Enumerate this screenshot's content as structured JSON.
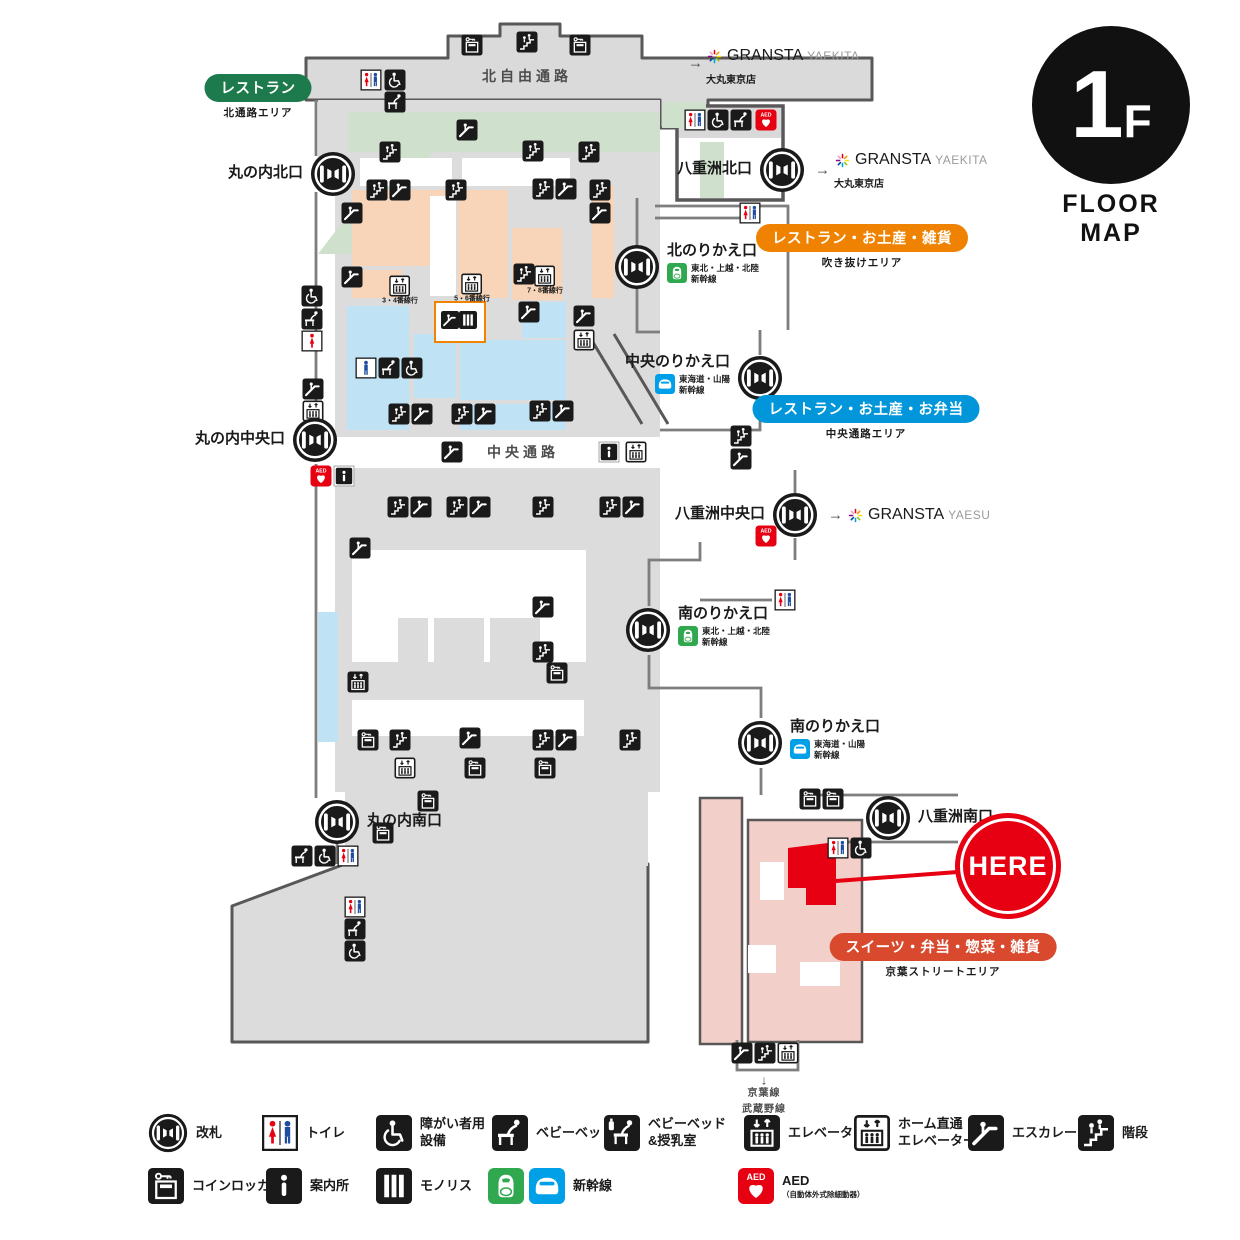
{
  "floor_badge": {
    "level_number": "1",
    "level_suffix": "F",
    "caption": "FLOOR MAP"
  },
  "colors": {
    "outline": "#595757",
    "floor_gray": "#dcdcdd",
    "green_area": "#cfe0cc",
    "peach_area": "#f8d5b8",
    "blue_area": "#bfe2f4",
    "pink_area": "#f3cfc9",
    "accent_red": "#e60012",
    "pill_green": "#1d7a4c",
    "pill_orange": "#ef8200",
    "pill_blue": "#0096d9",
    "pill_red": "#d8492e",
    "shinkansen_green": "#2fa84f",
    "shinkansen_blue": "#00a0e9"
  },
  "path_labels": [
    {
      "text": "北自由通路",
      "x": 527,
      "y": 76,
      "cls": ""
    },
    {
      "text": "中央通路",
      "x": 523,
      "y": 452,
      "cls": ""
    },
    {
      "text": "↓",
      "x": 764,
      "y": 1080,
      "cls": "tiny-arrow"
    },
    {
      "text": "京葉線\n武蔵野線",
      "x": 764,
      "y": 1102,
      "cls": "small"
    }
  ],
  "gates": [
    {
      "id": "marunouchi-north",
      "label": "丸の内北口",
      "x": 333,
      "y": 174,
      "side": "left"
    },
    {
      "id": "yaesu-north",
      "label": "八重洲北口",
      "x": 782,
      "y": 170,
      "side": "left",
      "arrow": "→",
      "logo": {
        "brand": "GRANSTA",
        "sub": "YAEKITA",
        "note": "大丸東京店"
      }
    },
    {
      "id": "north-transfer",
      "label": "北のりかえ口",
      "x": 637,
      "y": 267,
      "side": "right",
      "line": {
        "icon": "shinkansen-green",
        "text": "東北・上越・北陸\n新幹線"
      }
    },
    {
      "id": "central-transfer",
      "label": "中央のりかえ口",
      "x": 760,
      "y": 378,
      "side": "left",
      "line": {
        "icon": "shinkansen-blue",
        "text": "東海道・山陽\n新幹線"
      }
    },
    {
      "id": "marunouchi-central",
      "label": "丸の内中央口",
      "x": 315,
      "y": 440,
      "side": "left"
    },
    {
      "id": "yaesu-central",
      "label": "八重洲中央口",
      "x": 795,
      "y": 515,
      "side": "left",
      "arrow": "→",
      "logo": {
        "brand": "GRANSTA",
        "sub": "YAESU"
      }
    },
    {
      "id": "south-transfer-1",
      "label": "南のりかえ口",
      "x": 648,
      "y": 630,
      "side": "right",
      "line": {
        "icon": "shinkansen-green",
        "text": "東北・上越・北陸\n新幹線"
      }
    },
    {
      "id": "south-transfer-2",
      "label": "南のりかえ口",
      "x": 760,
      "y": 743,
      "side": "right",
      "line": {
        "icon": "shinkansen-blue",
        "text": "東海道・山陽\n新幹線"
      }
    },
    {
      "id": "marunouchi-south",
      "label": "丸の内南口",
      "x": 337,
      "y": 822,
      "side": "right"
    },
    {
      "id": "yaesu-south",
      "label": "八重洲南口",
      "x": 888,
      "y": 818,
      "side": "right"
    }
  ],
  "area_pills": [
    {
      "label": "レストラン",
      "sub": "北通路エリア",
      "color": "#1d7a4c",
      "x": 258,
      "y": 74
    },
    {
      "label": "レストラン・お土産・雑貨",
      "sub": "吹き抜けエリア",
      "color": "#ef8200",
      "x": 862,
      "y": 224
    },
    {
      "label": "レストラン・お土産・お弁当",
      "sub": "中央通路エリア",
      "color": "#0096d9",
      "x": 866,
      "y": 395
    },
    {
      "label": "スイーツ・弁当・惣菜・雑貨",
      "sub": "京葉ストリートエリア",
      "color": "#d8492e",
      "x": 943,
      "y": 933
    }
  ],
  "brand_links": [
    {
      "x": 688,
      "y": 63,
      "arrow": "→",
      "brand": "GRANSTA",
      "sub": "YAEKITA",
      "note": "大丸東京店"
    }
  ],
  "here_marker": {
    "label": "HERE",
    "x": 1008,
    "y": 866
  },
  "highlight_box": {
    "x": 434,
    "y": 301,
    "w": 48,
    "h": 38
  },
  "map_icons": [
    {
      "t": "locker",
      "x": 472,
      "y": 45
    },
    {
      "t": "stairs",
      "x": 527,
      "y": 42
    },
    {
      "t": "locker",
      "x": 580,
      "y": 45
    },
    {
      "t": "toilet",
      "x": 371,
      "y": 80
    },
    {
      "t": "wheelchair",
      "x": 395,
      "y": 80
    },
    {
      "t": "babybed",
      "x": 395,
      "y": 102
    },
    {
      "t": "escalator",
      "x": 467,
      "y": 130
    },
    {
      "t": "stairs",
      "x": 390,
      "y": 152
    },
    {
      "t": "stairs",
      "x": 533,
      "y": 151
    },
    {
      "t": "stairs",
      "x": 589,
      "y": 152
    },
    {
      "t": "toilet",
      "x": 695,
      "y": 120
    },
    {
      "t": "wheelchair",
      "x": 718,
      "y": 120
    },
    {
      "t": "babybed",
      "x": 741,
      "y": 120
    },
    {
      "t": "aed",
      "x": 766,
      "y": 120
    },
    {
      "t": "escalator",
      "x": 352,
      "y": 213
    },
    {
      "t": "stairs",
      "x": 377,
      "y": 190
    },
    {
      "t": "escalator",
      "x": 400,
      "y": 190
    },
    {
      "t": "stairs",
      "x": 456,
      "y": 190
    },
    {
      "t": "stairs",
      "x": 543,
      "y": 189
    },
    {
      "t": "escalator",
      "x": 566,
      "y": 189
    },
    {
      "t": "stairs",
      "x": 600,
      "y": 190
    },
    {
      "t": "escalator",
      "x": 600,
      "y": 213
    },
    {
      "t": "toilet",
      "x": 750,
      "y": 213
    },
    {
      "t": "escalator",
      "x": 352,
      "y": 277
    },
    {
      "t": "stairs",
      "x": 524,
      "y": 274
    },
    {
      "t": "elevator-home",
      "x": 400,
      "y": 290,
      "label": "3・4番線行"
    },
    {
      "t": "elevator-home",
      "x": 472,
      "y": 288,
      "label": "5・6番線行"
    },
    {
      "t": "elevator-home",
      "x": 545,
      "y": 280,
      "label": "7・8番線行"
    },
    {
      "t": "escalator",
      "x": 529,
      "y": 312
    },
    {
      "t": "escalator",
      "x": 584,
      "y": 316
    },
    {
      "t": "elevator-home",
      "x": 584,
      "y": 340
    },
    {
      "t": "wheelchair",
      "x": 312,
      "y": 296
    },
    {
      "t": "babybed",
      "x": 312,
      "y": 319
    },
    {
      "t": "toilet-w",
      "x": 312,
      "y": 341
    },
    {
      "t": "escalator",
      "x": 313,
      "y": 389
    },
    {
      "t": "elevator-home",
      "x": 313,
      "y": 411
    },
    {
      "t": "toilet-m",
      "x": 366,
      "y": 368
    },
    {
      "t": "babybed",
      "x": 389,
      "y": 368
    },
    {
      "t": "wheelchair",
      "x": 412,
      "y": 368
    },
    {
      "t": "stairs",
      "x": 399,
      "y": 414
    },
    {
      "t": "escalator",
      "x": 422,
      "y": 414
    },
    {
      "t": "stairs",
      "x": 462,
      "y": 414
    },
    {
      "t": "escalator",
      "x": 485,
      "y": 414
    },
    {
      "t": "stairs",
      "x": 540,
      "y": 411
    },
    {
      "t": "escalator",
      "x": 563,
      "y": 411
    },
    {
      "t": "escalator",
      "x": 452,
      "y": 452
    },
    {
      "t": "info-box",
      "x": 609,
      "y": 452
    },
    {
      "t": "elevator-home",
      "x": 636,
      "y": 452
    },
    {
      "t": "stairs",
      "x": 741,
      "y": 436
    },
    {
      "t": "escalator",
      "x": 741,
      "y": 459
    },
    {
      "t": "aed",
      "x": 321,
      "y": 476
    },
    {
      "t": "info-box",
      "x": 344,
      "y": 476
    },
    {
      "t": "stairs",
      "x": 398,
      "y": 507
    },
    {
      "t": "escalator",
      "x": 421,
      "y": 507
    },
    {
      "t": "stairs",
      "x": 457,
      "y": 507
    },
    {
      "t": "escalator",
      "x": 480,
      "y": 507
    },
    {
      "t": "stairs",
      "x": 543,
      "y": 507
    },
    {
      "t": "stairs",
      "x": 610,
      "y": 507
    },
    {
      "t": "escalator",
      "x": 633,
      "y": 507
    },
    {
      "t": "escalator",
      "x": 360,
      "y": 548
    },
    {
      "t": "escalator",
      "x": 543,
      "y": 607
    },
    {
      "t": "toilet",
      "x": 785,
      "y": 600
    },
    {
      "t": "stairs",
      "x": 543,
      "y": 652
    },
    {
      "t": "locker",
      "x": 557,
      "y": 673
    },
    {
      "t": "elevator",
      "x": 358,
      "y": 682
    },
    {
      "t": "aed",
      "x": 766,
      "y": 536
    },
    {
      "t": "locker",
      "x": 368,
      "y": 740
    },
    {
      "t": "stairs",
      "x": 400,
      "y": 740
    },
    {
      "t": "escalator",
      "x": 470,
      "y": 738
    },
    {
      "t": "stairs",
      "x": 543,
      "y": 740
    },
    {
      "t": "escalator",
      "x": 566,
      "y": 740
    },
    {
      "t": "stairs",
      "x": 630,
      "y": 740
    },
    {
      "t": "elevator-home",
      "x": 405,
      "y": 768
    },
    {
      "t": "locker",
      "x": 475,
      "y": 768
    },
    {
      "t": "locker",
      "x": 545,
      "y": 768
    },
    {
      "t": "locker",
      "x": 428,
      "y": 801
    },
    {
      "t": "locker",
      "x": 383,
      "y": 833
    },
    {
      "t": "babybed",
      "x": 302,
      "y": 856
    },
    {
      "t": "wheelchair",
      "x": 325,
      "y": 856
    },
    {
      "t": "toilet",
      "x": 348,
      "y": 856
    },
    {
      "t": "toilet",
      "x": 355,
      "y": 907
    },
    {
      "t": "babybed",
      "x": 355,
      "y": 929
    },
    {
      "t": "wheelchair",
      "x": 355,
      "y": 951
    },
    {
      "t": "locker",
      "x": 810,
      "y": 799
    },
    {
      "t": "locker",
      "x": 833,
      "y": 799
    },
    {
      "t": "toilet",
      "x": 838,
      "y": 848
    },
    {
      "t": "wheelchair",
      "x": 861,
      "y": 848
    },
    {
      "t": "escalator",
      "x": 742,
      "y": 1053
    },
    {
      "t": "stairs",
      "x": 765,
      "y": 1053
    },
    {
      "t": "elevator-home",
      "x": 788,
      "y": 1053
    },
    {
      "t": "escalator",
      "x": 450,
      "y": 320,
      "s": 18
    },
    {
      "t": "monolith",
      "x": 468,
      "y": 320,
      "s": 18
    }
  ],
  "legend": {
    "rows": [
      {
        "y": 1133,
        "items": [
          {
            "icon": "gate",
            "label": "改札",
            "x": 148
          },
          {
            "icon": "toilet",
            "label": "トイレ",
            "x": 262
          },
          {
            "icon": "wheelchair",
            "label": "障がい者用\n設備",
            "x": 376
          },
          {
            "icon": "babybed",
            "label": "ベビーベッド",
            "x": 492
          },
          {
            "icon": "nursing",
            "label": "ベビーベッド\n&授乳室",
            "x": 604
          },
          {
            "icon": "elevator",
            "label": "エレベーター",
            "x": 744
          },
          {
            "icon": "elevator-home",
            "label": "ホーム直通\nエレベーター",
            "x": 854
          },
          {
            "icon": "escalator",
            "label": "エスカレーター",
            "x": 968
          },
          {
            "icon": "stairs",
            "label": "階段",
            "x": 1078
          }
        ]
      },
      {
        "y": 1186,
        "items": [
          {
            "icon": "locker",
            "label": "コインロッカー",
            "x": 148
          },
          {
            "icon": "info",
            "label": "案内所",
            "x": 266
          },
          {
            "icon": "monolith",
            "label": "モノリス",
            "x": 376
          },
          {
            "icon": "shinkansen-pair",
            "label": "新幹線",
            "x": 488
          },
          {
            "icon": "aed",
            "label": "AED",
            "sub": "（自動体外式除細動器）",
            "x": 738
          }
        ]
      }
    ]
  }
}
